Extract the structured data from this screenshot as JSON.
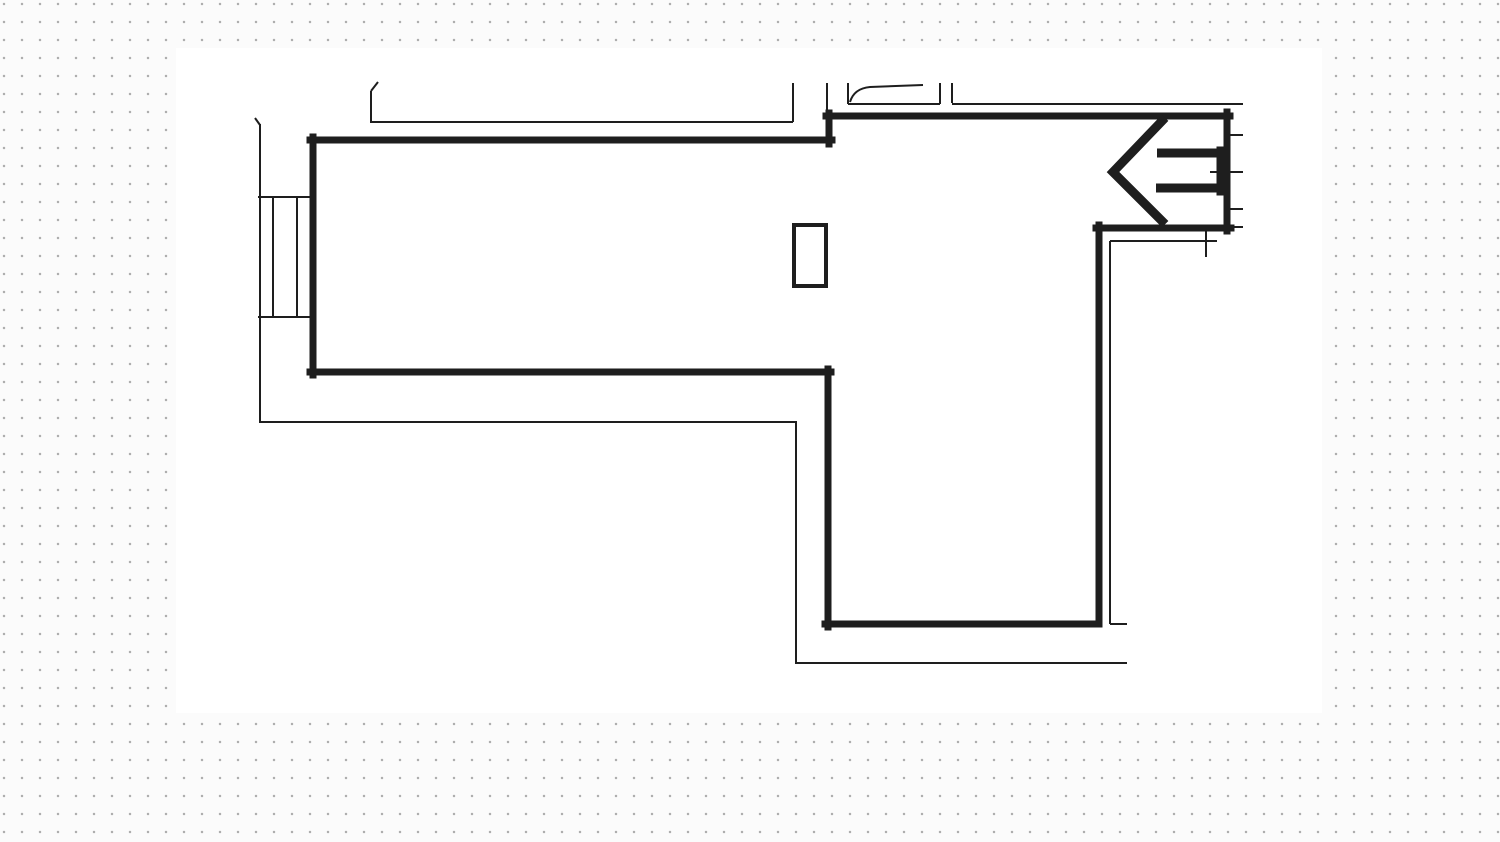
{
  "meta": {
    "description": "Hand-traced architectural floor plan line drawing (L-shaped room with entrance arrow) on a dotted-grid background",
    "width_px": 1500,
    "height_px": 842
  },
  "background": {
    "margin_color": "#fbfbfb",
    "dot_color": "#aeaeae",
    "dot_spacing_px": 18,
    "paper_color": "#ffffff",
    "paper_rect": {
      "x": 176,
      "y": 48,
      "width": 1146,
      "height": 665
    }
  },
  "floorplan": {
    "stroke_color": "#1e1e1e",
    "thick_stroke_px": 7,
    "thin_stroke_px": 2,
    "thick_walls": [
      {
        "name": "left-room-top-wall",
        "x1": 310,
        "y1": 140,
        "x2": 832,
        "y2": 140
      },
      {
        "name": "left-room-left-wall",
        "x1": 313,
        "y1": 137,
        "x2": 313,
        "y2": 375
      },
      {
        "name": "left-room-bottom-wall",
        "x1": 310,
        "y1": 372,
        "x2": 831,
        "y2": 372
      },
      {
        "name": "top-step-wall",
        "x1": 829,
        "y1": 113,
        "x2": 829,
        "y2": 144
      },
      {
        "name": "upper-right-top-wall",
        "x1": 826,
        "y1": 116,
        "x2": 1230,
        "y2": 116
      },
      {
        "name": "corridor-left-wall",
        "x1": 828,
        "y1": 369,
        "x2": 828,
        "y2": 627
      },
      {
        "name": "corridor-bottom-wall",
        "x1": 825,
        "y1": 624,
        "x2": 1099,
        "y2": 624
      },
      {
        "name": "corridor-right-wall",
        "x1": 1099,
        "y1": 225,
        "x2": 1099,
        "y2": 624
      },
      {
        "name": "vestibule-bottom-wall",
        "x1": 1096,
        "y1": 228,
        "x2": 1231,
        "y2": 228
      },
      {
        "name": "vestibule-right-wall",
        "x1": 1227,
        "y1": 112,
        "x2": 1227,
        "y2": 231
      }
    ],
    "entrance_arrow": {
      "head_points": "1162,121 1113,172 1162,221",
      "head_stroke_px": 9,
      "shaft_top": {
        "name": "entrance-arrow-shaft-top",
        "x1": 1157,
        "y1": 153,
        "x2": 1222,
        "y2": 153,
        "w": 9
      },
      "shaft_bottom": {
        "name": "entrance-arrow-shaft-bottom",
        "x1": 1156,
        "y1": 188,
        "x2": 1222,
        "y2": 188,
        "w": 9
      },
      "base": {
        "name": "entrance-arrow-base",
        "x1": 1220,
        "y1": 150,
        "x2": 1220,
        "y2": 192,
        "w": 7
      }
    },
    "pillar": {
      "x": 794,
      "y": 225,
      "width": 32,
      "height": 61,
      "stroke_px": 4
    },
    "window_left": [
      {
        "name": "left-window-top-line",
        "x1": 258,
        "y1": 197,
        "x2": 315,
        "y2": 197
      },
      {
        "name": "left-window-bottom-line",
        "x1": 258,
        "y1": 317,
        "x2": 315,
        "y2": 317
      },
      {
        "name": "left-window-mullion-1",
        "x1": 273,
        "y1": 197,
        "x2": 273,
        "y2": 317
      },
      {
        "name": "left-window-mullion-2",
        "x1": 297,
        "y1": 197,
        "x2": 297,
        "y2": 317
      }
    ],
    "door": {
      "left_jamb": {
        "name": "door-left-jamb",
        "x1": 848,
        "y1": 83,
        "x2": 848,
        "y2": 104
      },
      "sill": {
        "name": "door-sill-line",
        "x1": 848,
        "y1": 104,
        "x2": 940,
        "y2": 104
      },
      "right_jamb": {
        "name": "door-right-jamb",
        "x1": 940,
        "y1": 83,
        "x2": 940,
        "y2": 104
      },
      "swing_path": "M850,102 C853,92 860,88 870,87 L923,85"
    },
    "thin_lines": [
      {
        "name": "outer-left-wall-line",
        "x1": 260,
        "y1": 124,
        "x2": 260,
        "y2": 422
      },
      {
        "name": "outer-left-top-hook",
        "x1": 260,
        "y1": 125,
        "x2": 255,
        "y2": 118
      },
      {
        "name": "outer-bottom-left-line",
        "x1": 259,
        "y1": 422,
        "x2": 796,
        "y2": 422
      },
      {
        "name": "outer-step-line",
        "x1": 796,
        "y1": 421,
        "x2": 796,
        "y2": 663
      },
      {
        "name": "outer-bottom-line",
        "x1": 795,
        "y1": 663,
        "x2": 1127,
        "y2": 663
      },
      {
        "name": "inner-top-line",
        "x1": 371,
        "y1": 122,
        "x2": 793,
        "y2": 122
      },
      {
        "name": "inner-top-left-end",
        "x1": 371,
        "y1": 91,
        "x2": 371,
        "y2": 123
      },
      {
        "name": "inner-top-left-hook",
        "x1": 371,
        "y1": 91,
        "x2": 378,
        "y2": 82
      },
      {
        "name": "inner-top-right-end",
        "x1": 793,
        "y1": 83,
        "x2": 793,
        "y2": 122
      },
      {
        "name": "step-upper-line",
        "x1": 827,
        "y1": 83,
        "x2": 827,
        "y2": 114
      },
      {
        "name": "upper-corridor-vertical-line",
        "x1": 952,
        "y1": 83,
        "x2": 952,
        "y2": 103
      },
      {
        "name": "upper-corridor-horizontal-line",
        "x1": 952,
        "y1": 104,
        "x2": 1243,
        "y2": 104
      },
      {
        "name": "entry-side-stub-1",
        "x1": 1230,
        "y1": 135,
        "x2": 1243,
        "y2": 135
      },
      {
        "name": "entry-side-stub-2",
        "x1": 1210,
        "y1": 172,
        "x2": 1243,
        "y2": 172
      },
      {
        "name": "entry-side-stub-3",
        "x1": 1230,
        "y1": 209,
        "x2": 1243,
        "y2": 209
      },
      {
        "name": "entry-side-stub-4",
        "x1": 1231,
        "y1": 227,
        "x2": 1243,
        "y2": 227
      },
      {
        "name": "entry-inner-vertical",
        "x1": 1206,
        "y1": 231,
        "x2": 1206,
        "y2": 257
      },
      {
        "name": "corridor-outer-top-line",
        "x1": 1110,
        "y1": 241,
        "x2": 1217,
        "y2": 241
      },
      {
        "name": "corridor-outer-right-line",
        "x1": 1110,
        "y1": 241,
        "x2": 1110,
        "y2": 624
      },
      {
        "name": "corridor-outer-bottom-hook",
        "x1": 1110,
        "y1": 624,
        "x2": 1127,
        "y2": 624
      }
    ]
  }
}
